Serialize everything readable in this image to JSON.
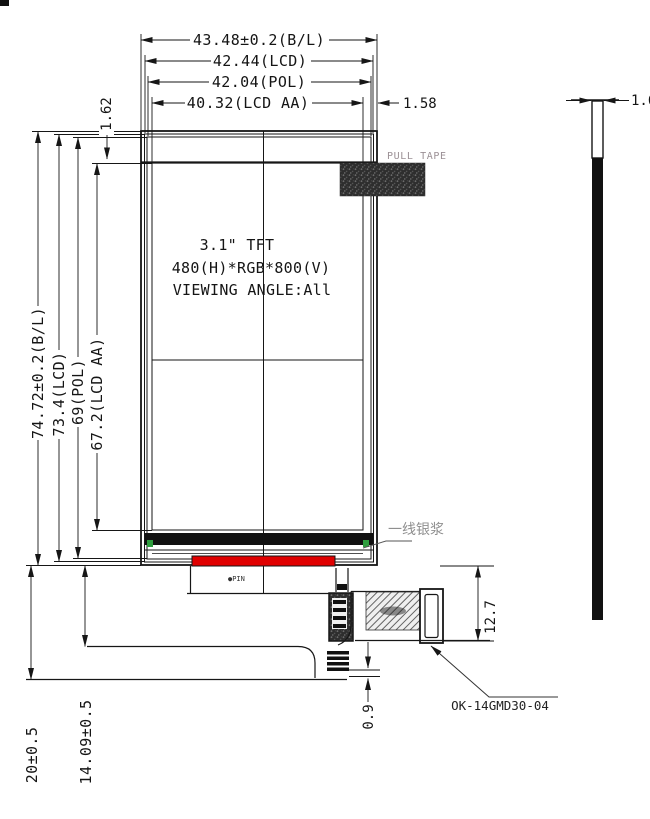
{
  "front_view": {
    "display_lines": {
      "l1": "3.1\" TFT",
      "l2": "480(H)*RGB*800(V)",
      "l3": "VIEWING ANGLE:All"
    },
    "pull_tape_label": "PULL TAPE",
    "silver_paste_label": "一线银浆",
    "pin_marker": "●PIN"
  },
  "dimensions": {
    "top": {
      "backlight_width": "43.48±0.2(B/L)",
      "lcd_width": "42.44(LCD)",
      "pol_width": "42.04(POL)",
      "active_area_width": "40.32(LCD AA)",
      "right_edge_gap": "1.58",
      "top_edge_gap": "1.62"
    },
    "left": {
      "backlight_height": "74.72±0.2(B/L)",
      "lcd_height": "73.4(LCD)",
      "pol_height": "69(POL)",
      "active_area_height": "67.2(LCD AA)"
    },
    "bottom": {
      "fpc_overall": "20±0.5",
      "fpc_fold": "14.09±0.5",
      "stiffener_thickness": "0.9",
      "connector_offset": "12.7"
    },
    "side": {
      "module_thickness": "1.6"
    }
  },
  "connector": {
    "part_number": "OK-14GMD30-04"
  },
  "colors": {
    "line": "#161616",
    "bonding_bar": "#e00000",
    "alignment_mark": "#2f9e3f",
    "tape_fill": "#2e2e2e",
    "gray_label": "#9b9095"
  }
}
